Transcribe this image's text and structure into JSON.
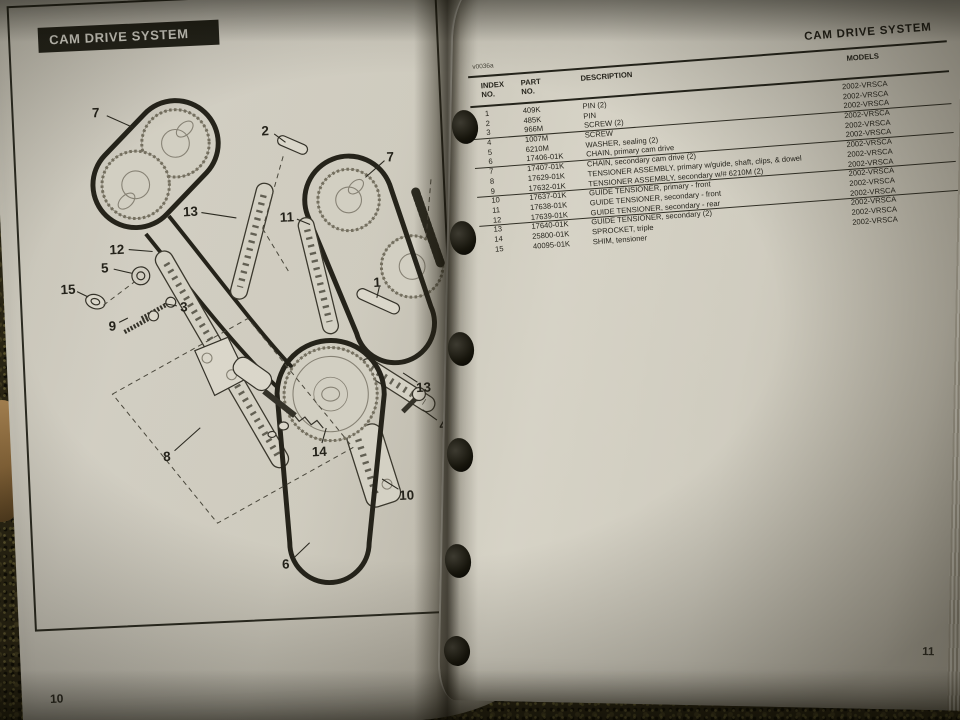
{
  "left_page": {
    "banner_title": "CAM DRIVE SYSTEM",
    "page_number": "10",
    "diagram": {
      "callouts": [
        {
          "n": "7",
          "x": 61,
          "y": 78,
          "x1": 72,
          "y1": 81,
          "x2": 98,
          "y2": 94
        },
        {
          "n": "2",
          "x": 231,
          "y": 104,
          "x1": 240,
          "y1": 107,
          "x2": 251,
          "y2": 116
        },
        {
          "n": "7",
          "x": 356,
          "y": 136,
          "x1": 350,
          "y1": 139,
          "x2": 330,
          "y2": 155
        },
        {
          "n": "13",
          "x": 152,
          "y": 182,
          "x1": 163,
          "y1": 183,
          "x2": 198,
          "y2": 190
        },
        {
          "n": "11",
          "x": 249,
          "y": 192,
          "x1": 259,
          "y1": 194,
          "x2": 272,
          "y2": 200
        },
        {
          "n": "12",
          "x": 76,
          "y": 217,
          "x1": 88,
          "y1": 217,
          "x2": 112,
          "y2": 220
        },
        {
          "n": "5",
          "x": 63,
          "y": 235,
          "x1": 72,
          "y1": 236,
          "x2": 90,
          "y2": 241
        },
        {
          "n": "15",
          "x": 25,
          "y": 255,
          "x1": 34,
          "y1": 257,
          "x2": 45,
          "y2": 263
        },
        {
          "n": "3",
          "x": 141,
          "y": 278,
          "x1": 134,
          "y1": 276,
          "x2": 121,
          "y2": 273
        },
        {
          "n": "9",
          "x": 68,
          "y": 294,
          "x1": 75,
          "y1": 290,
          "x2": 84,
          "y2": 286
        },
        {
          "n": "1",
          "x": 337,
          "y": 262,
          "x1": 339,
          "y1": 266,
          "x2": 336,
          "y2": 277
        },
        {
          "n": "8",
          "x": 117,
          "y": 428,
          "x1": 125,
          "y1": 422,
          "x2": 152,
          "y2": 400
        },
        {
          "n": "14",
          "x": 271,
          "y": 430,
          "x1": 274,
          "y1": 421,
          "x2": 279,
          "y2": 406
        },
        {
          "n": "13",
          "x": 379,
          "y": 370,
          "x1": 373,
          "y1": 364,
          "x2": 359,
          "y2": 354
        },
        {
          "n": "4",
          "x": 397,
          "y": 409,
          "x1": 391,
          "y1": 403,
          "x2": 377,
          "y2": 392
        },
        {
          "n": "10",
          "x": 357,
          "y": 478,
          "x1": 349,
          "y1": 471,
          "x2": 333,
          "y2": 460
        },
        {
          "n": "6",
          "x": 232,
          "y": 542,
          "x1": 241,
          "y1": 535,
          "x2": 257,
          "y2": 521
        }
      ]
    }
  },
  "right_page": {
    "header_title": "CAM DRIVE SYSTEM",
    "figure_code": "v0036a",
    "page_number": "11",
    "table": {
      "columns": [
        "INDEX\nNO.",
        "PART\nNO.",
        "DESCRIPTION",
        "MODELS"
      ],
      "rows": [
        {
          "index": "1",
          "part": "409K",
          "desc": "PIN (2)",
          "models": "2002-VRSCA"
        },
        {
          "index": "2",
          "part": "485K",
          "desc": "PIN",
          "models": "2002-VRSCA"
        },
        {
          "index": "3",
          "part": "966M",
          "desc": "SCREW (2)",
          "models": "2002-VRSCA"
        },
        {
          "index": "4",
          "part": "1007M",
          "desc": "SCREW",
          "models": "2002-VRSCA"
        },
        {
          "index": "5",
          "part": "6210M",
          "desc": "WASHER, sealing (2)",
          "models": "2002-VRSCA"
        },
        {
          "index": "6",
          "part": "17406-01K",
          "desc": "CHAIN, primary cam drive",
          "models": "2002-VRSCA"
        },
        {
          "index": "7",
          "part": "17407-01K",
          "desc": "CHAIN, secondary cam drive (2)",
          "models": "2002-VRSCA"
        },
        {
          "index": "8",
          "part": "17629-01K",
          "desc": "TENSIONER ASSEMBLY, primary w/guide, shaft, clips, & dowel",
          "models": "2002-VRSCA"
        },
        {
          "index": "9",
          "part": "17632-01K",
          "desc": "TENSIONER ASSEMBLY, secondary w/# 6210M (2)",
          "models": "2002-VRSCA"
        },
        {
          "index": "10",
          "part": "17637-01K",
          "desc": "GUIDE TENSIONER, primary - front",
          "models": "2002-VRSCA"
        },
        {
          "index": "11",
          "part": "17638-01K",
          "desc": "GUIDE TENSIONER, secondary - front",
          "models": "2002-VRSCA"
        },
        {
          "index": "12",
          "part": "17639-01K",
          "desc": "GUIDE TENSIONER, secondary - rear",
          "models": "2002-VRSCA"
        },
        {
          "index": "13",
          "part": "17640-01K",
          "desc": "GUIDE TENSIONER, secondary (2)",
          "models": "2002-VRSCA"
        },
        {
          "index": "14",
          "part": "25800-01K",
          "desc": "SPROCKET, triple",
          "models": "2002-VRSCA"
        },
        {
          "index": "15",
          "part": "40095-01K",
          "desc": "SHIM, tensioner",
          "models": "2002-VRSCA"
        }
      ]
    }
  },
  "colors": {
    "banner_bg": "#21211a",
    "banner_text": "#dcdbd3",
    "page": "#d6d3c8",
    "ink": "#26251f",
    "carpet": "#282414"
  }
}
